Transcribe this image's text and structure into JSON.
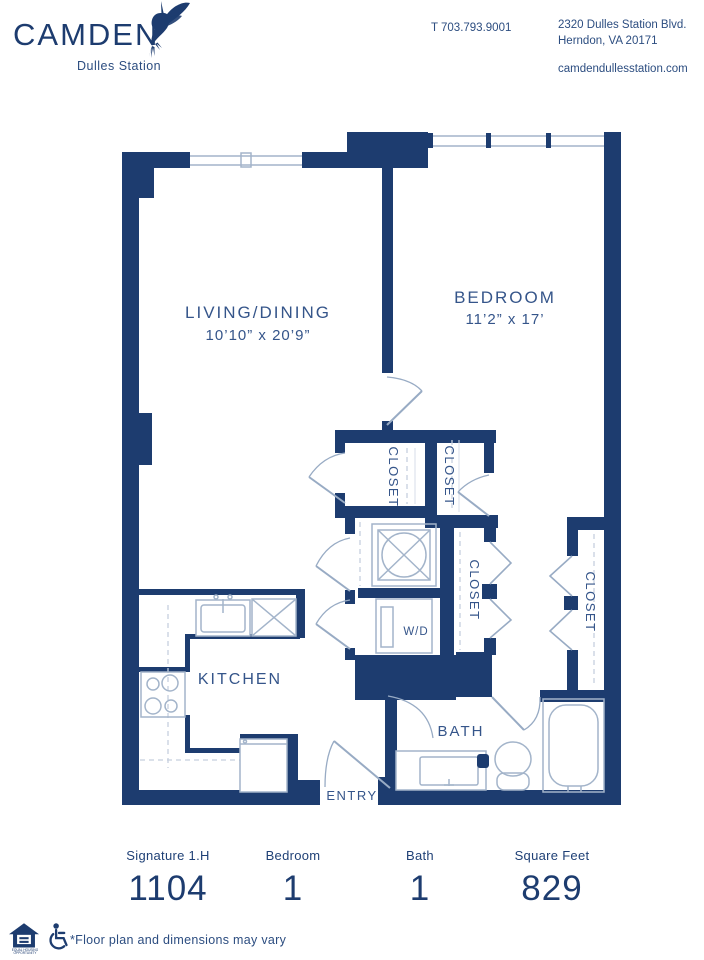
{
  "header": {
    "brand": "CAMDEN",
    "community": "Dulles Station",
    "phone": "T 703.793.9001",
    "address1": "2320 Dulles Station Blvd.",
    "address2": "Herndon, VA 20171",
    "website": "camdendullesstation.com"
  },
  "plan": {
    "living_name": "LIVING/DINING",
    "living_dims": "10’10” x 20’9”",
    "bedroom_name": "BEDROOM",
    "bedroom_dims": "11’2” x 17’",
    "kitchen": "KITCHEN",
    "bath": "BATH",
    "entry": "ENTRY",
    "washer_dryer": "W/D",
    "closet": "CLOSET"
  },
  "stats": [
    {
      "label": "Signature 1.H",
      "value": "1104"
    },
    {
      "label": "Bedroom",
      "value": "1"
    },
    {
      "label": "Bath",
      "value": "1"
    },
    {
      "label": "Square Feet",
      "value": "829"
    }
  ],
  "footer": {
    "disclaimer": "*Floor plan and dimensions may vary",
    "equal_housing_caption": "EQUAL HOUSING OPPORTUNITY"
  },
  "colors": {
    "wall_navy": "#1d3c6f",
    "label_navy": "#35558a",
    "fixture_line": "#a3b4ca"
  }
}
